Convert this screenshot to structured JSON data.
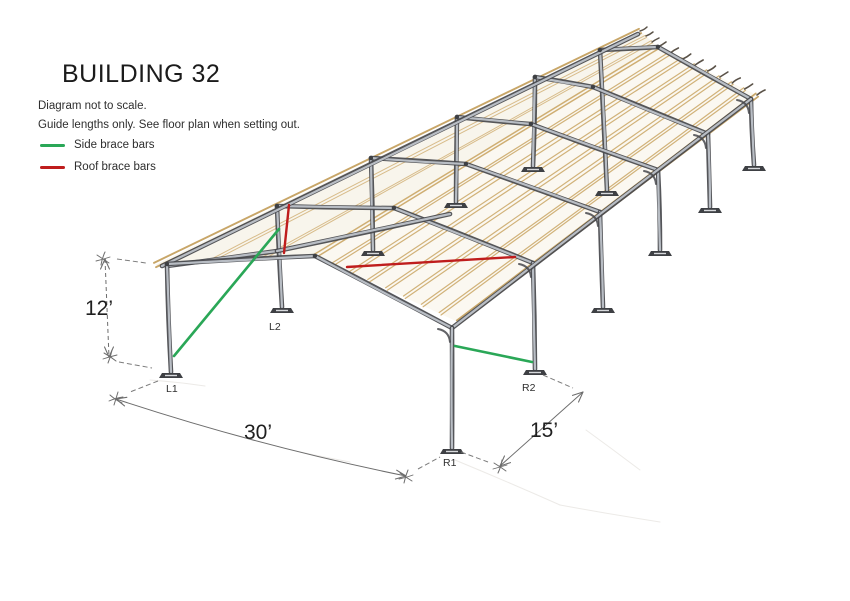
{
  "title": "BUILDING 32",
  "notes": {
    "line1": "Diagram not to scale.",
    "line2": "Guide lengths only. See floor plan when setting out."
  },
  "legend": {
    "side_brace": {
      "label": "Side brace bars",
      "color": "#2aa757"
    },
    "roof_brace": {
      "label": "Roof brace bars",
      "color": "#bf1d1d"
    }
  },
  "dimensions": {
    "eave_height": "12’",
    "front_span": "30’",
    "bay_spacing": "15’"
  },
  "column_labels": {
    "l1": "L1",
    "l2": "L2",
    "r1": "R1",
    "r2": "R2"
  },
  "structure": {
    "frame_count": 6,
    "bay_count": 5,
    "side_braces": [
      {
        "color_key": "side_brace",
        "from": "L1 column base",
        "to": "L2 column eave"
      },
      {
        "color_key": "side_brace",
        "from": "R1 column",
        "to": "R2 column base"
      }
    ],
    "roof_braces": [
      {
        "color_key": "roof_brace",
        "from": "L2 eave",
        "to": "front frame left rafter"
      },
      {
        "color_key": "roof_brace",
        "from": "front frame right rafter",
        "to": "R2 eave"
      }
    ],
    "colors": {
      "purlin_tan": "#cfae72",
      "steel_dark": "#46484c",
      "steel_light": "#b8bdc4",
      "pencil_gray": "#6d6d6d"
    }
  }
}
